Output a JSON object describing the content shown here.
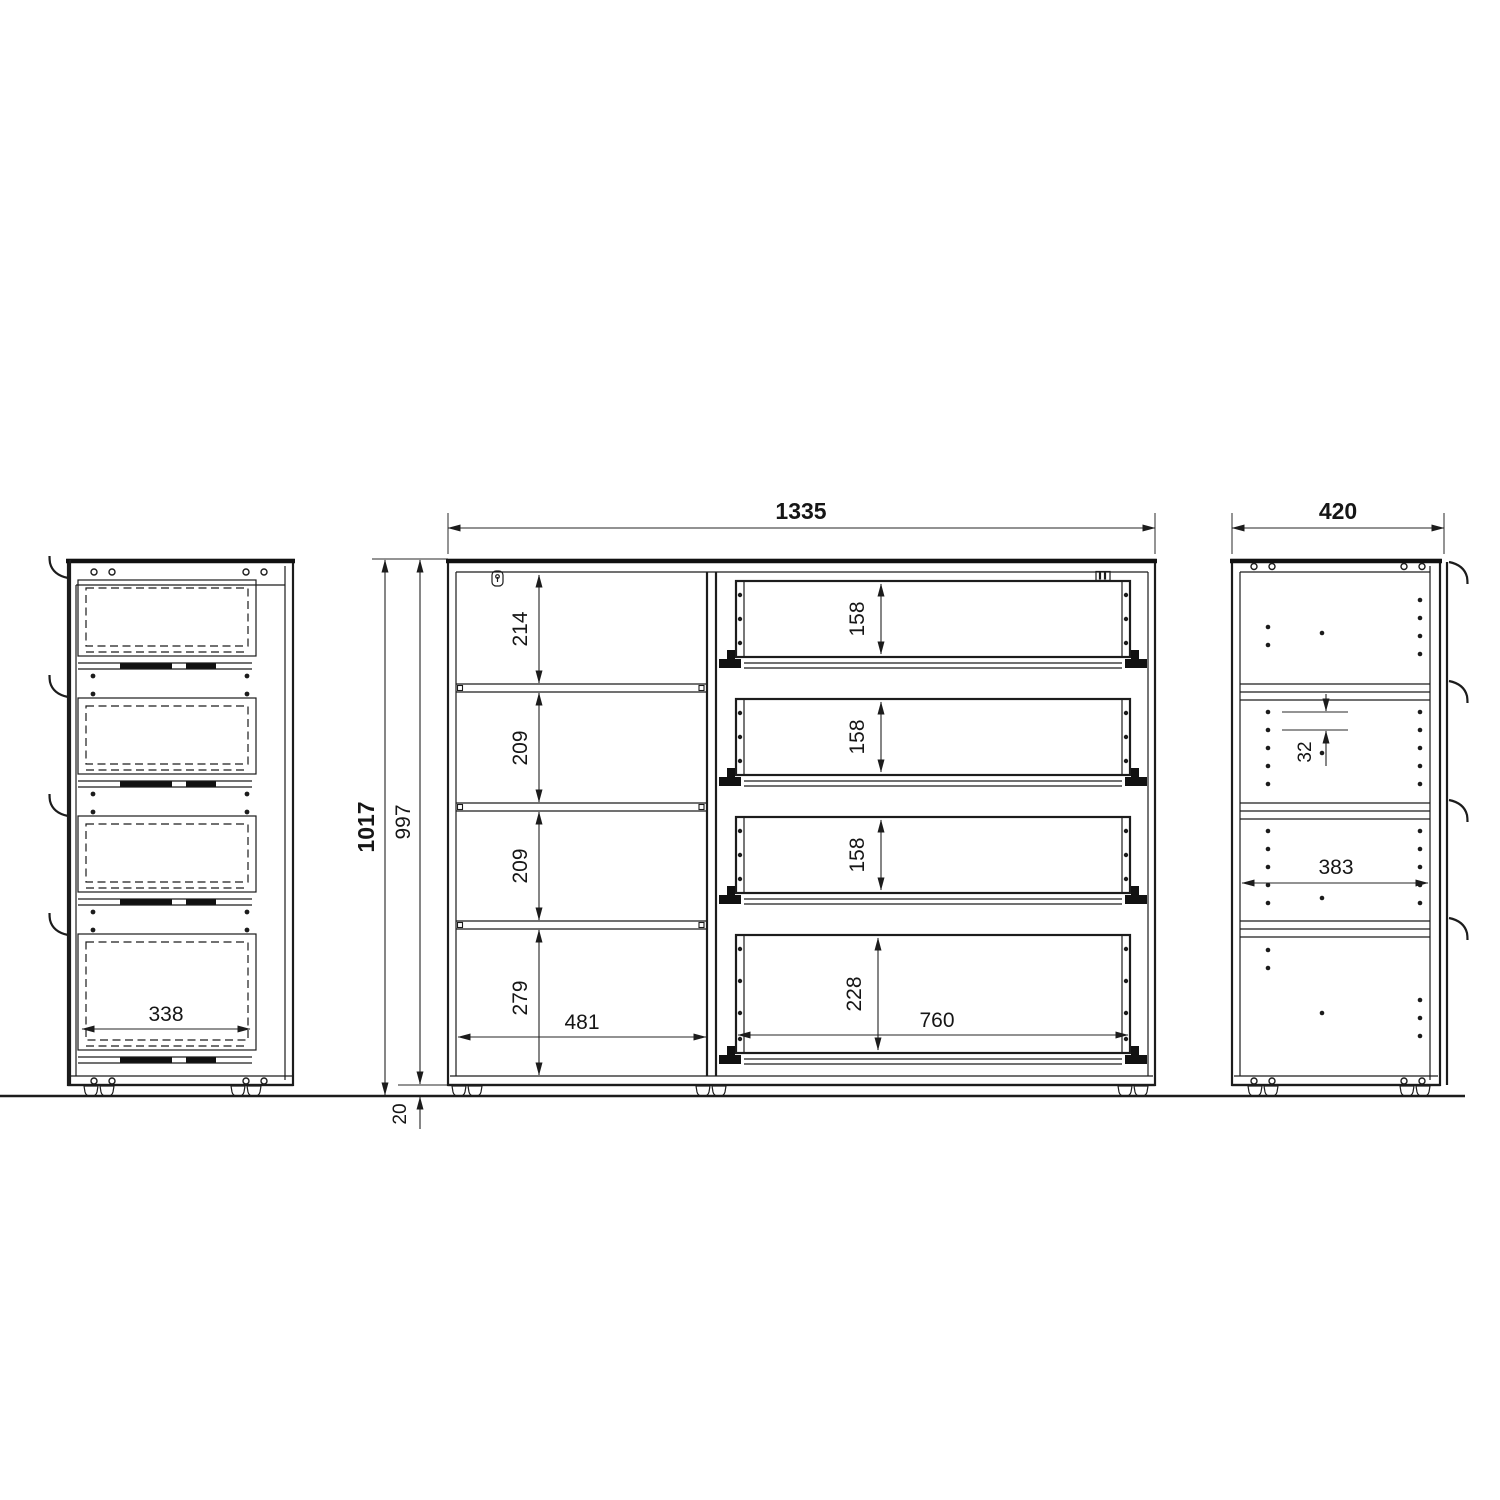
{
  "drawing_type": "furniture-orthographic-views",
  "colors": {
    "line": "#1c1c1c",
    "background": "#ffffff"
  },
  "views": {
    "left_side": {
      "label": "side-view-with-drawers",
      "dim_drawer_width": "338"
    },
    "front": {
      "label": "front-section-view",
      "dim_width": "1335",
      "dim_total_height": "1017",
      "dim_body_height": "997",
      "dim_foot_height": "20",
      "left_column": {
        "dim_inner_width": "481",
        "compartment_heights": [
          "214",
          "209",
          "209",
          "279"
        ]
      },
      "right_column": {
        "dim_inner_width": "760",
        "drawer_heights": [
          "158",
          "158",
          "158",
          "228"
        ]
      }
    },
    "right_side": {
      "label": "side-view-with-shelves",
      "dim_depth": "420",
      "dim_inner_depth": "383",
      "dim_hole_pitch": "32"
    }
  }
}
